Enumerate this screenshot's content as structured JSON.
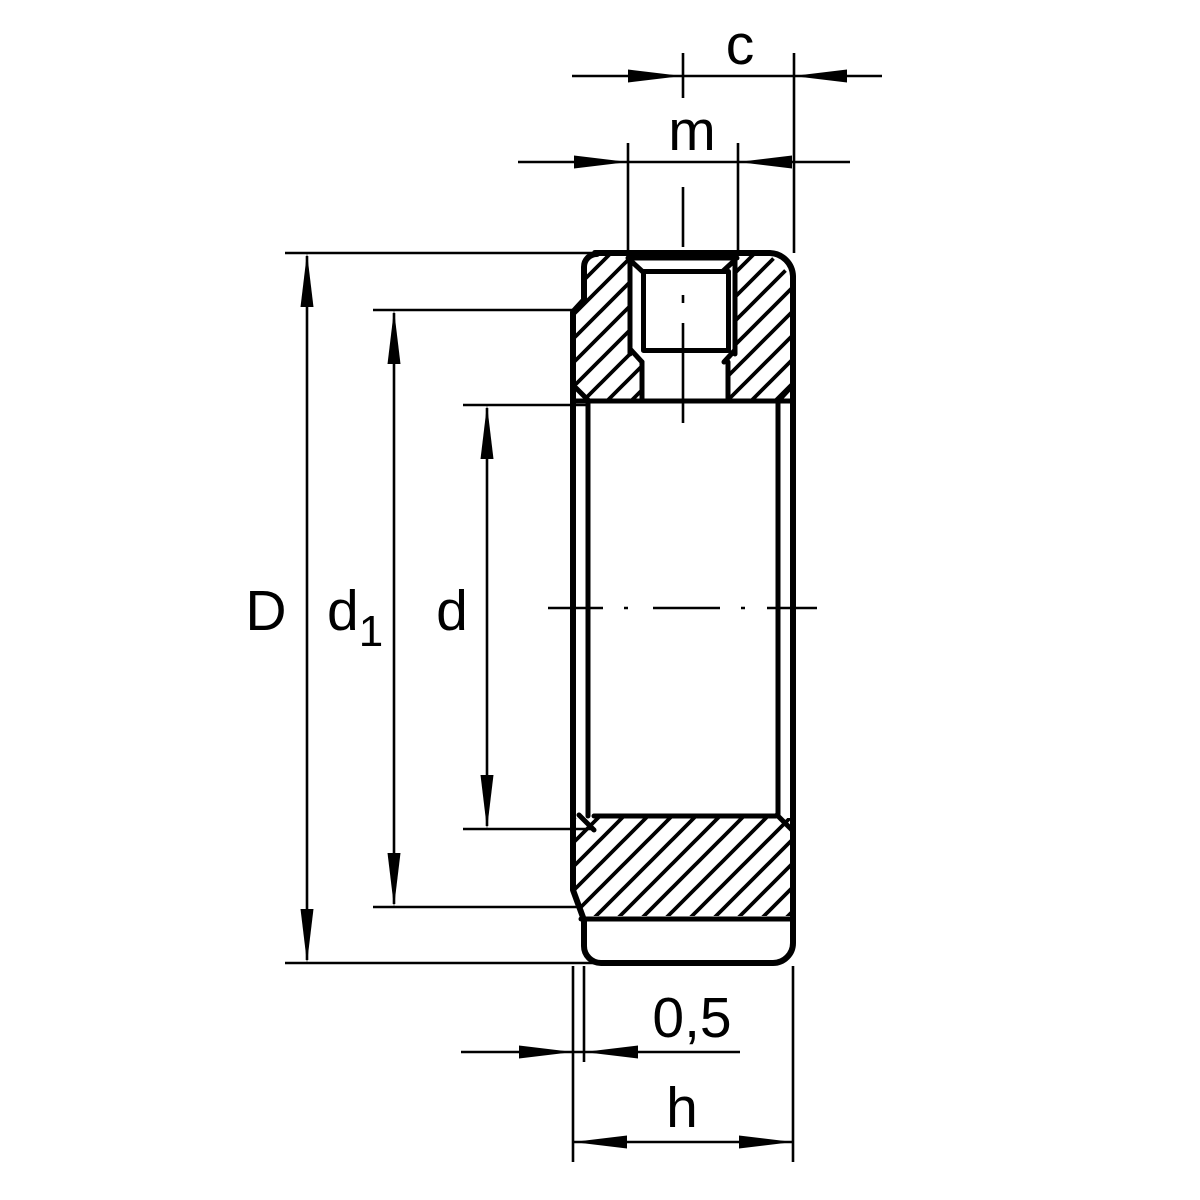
{
  "drawing": {
    "title": "locknut-sectional-drawing",
    "background": "#ffffff",
    "line_color": "#000000",
    "labels": {
      "c": "c",
      "m": "m",
      "D": "D",
      "d1_base": "d",
      "d1_sub": "1",
      "d": "d",
      "lip_offset": "0,5",
      "height": "h"
    }
  }
}
